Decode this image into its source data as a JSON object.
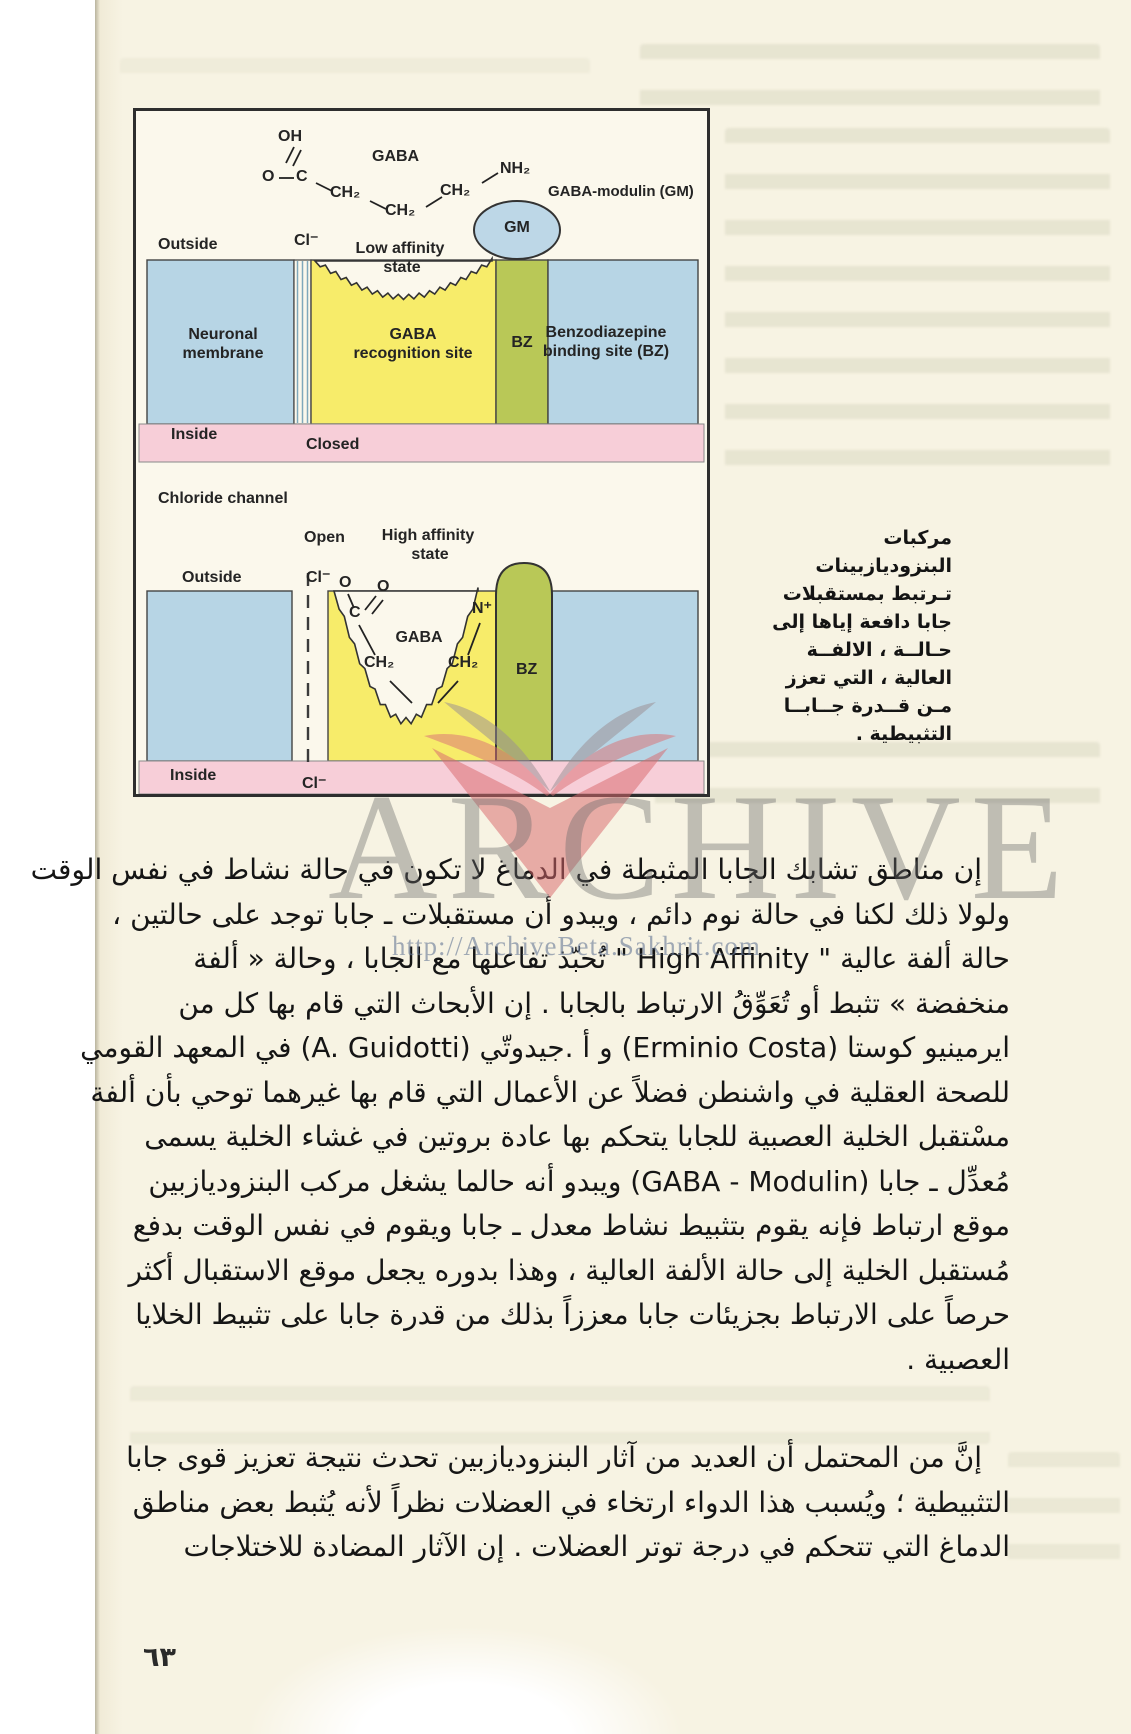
{
  "page": {
    "page_number": "٦٣",
    "watermark": {
      "logo": "open-book-logo",
      "text": "ARCHIVE",
      "url": "http://ArchiveBeta.Sakhrit.com"
    }
  },
  "figure": {
    "panel1": {
      "oh": "OH",
      "o": "O",
      "c": "C",
      "ch2a": "CH₂",
      "ch2b": "CH₂",
      "ch2c": "CH₂",
      "nh2": "NH₂",
      "gaba": "GABA",
      "gaba_modulin": "GABA-modulin (GM)",
      "gm": "GM",
      "outside": "Outside",
      "cl": "Cl⁻",
      "low_affinity": "Low affinity",
      "state": "state",
      "neuronal1": "Neuronal",
      "neuronal2": "membrane",
      "recog1": "GABA",
      "recog2": "recognition site",
      "bz": "BZ",
      "benzo1": "Benzodiazepine",
      "benzo2": "binding site (BZ)",
      "inside": "Inside",
      "closed": "Closed"
    },
    "panel2": {
      "chloride_channel": "Chloride channel",
      "open": "Open",
      "high_affinity": "High affinity",
      "state": "state",
      "outside": "Outside",
      "cl": "Cl⁻",
      "o1": "O",
      "o2": "O",
      "c": "C",
      "gaba": "GABA",
      "nplus": "N⁺",
      "ch2a": "CH₂",
      "ch2b": "CH₂",
      "ch2c": "CH₂",
      "bz": "BZ",
      "inside": "Inside",
      "cl2": "Cl⁻"
    },
    "caption_lines": [
      "مركبات",
      "البنزوديازبينات",
      "تـرتبط بمستقبلات",
      "جابا دافعة إياها إلى",
      "حـالــة ، الالفــة",
      "العالية ، التي تعزز",
      "مـن قــدرة جــابــا",
      "التثبيطية ."
    ]
  },
  "body": {
    "p1": [
      "إن مناطق تشابك الجابا المثبطة في الدماغ لا تكون في حالة نشاط في نفس الوقت",
      "ولولا ذلك لكنا في حالة نوم دائم ، ويبدو أن مستقبلات ـ جابا توجد على حالتين ،",
      "حالة ألفة عالية \" High Affinity \" تُحبّذ تفاعلها مع الجابا ، وحالة « ألفة",
      "منخفضة » تثبط أو تُعَوِّقُ الارتباط بالجابا . إن الأبحاث التي قام بها كل من",
      "ايرمينيو كوستا (Erminio Costa) و أ .جيدوتّي (A. Guidotti) في المعهد القومي",
      "للصحة العقلية في واشنطن فضلاً عن الأعمال التي قام بها غيرهما توحي بأن ألفة",
      "مسْتقبل الخلية العصبية للجابا يتحكم بها عادة بروتين في غشاء الخلية يسمى",
      "مُعدِّل ـ جابا (GABA - Modulin) ويبدو أنه حالما يشغل مركب البنزوديازبين",
      "موقع ارتباط فإنه يقوم بتثبيط نشاط معدل ـ جابا ويقوم في نفس الوقت بدفع",
      "مُستقبل الخلية إلى حالة الألفة العالية ، وهذا بدوره يجعل موقع الاستقبال أكثر",
      "حرصاً على الارتباط بجزيئات جابا معززاً بذلك من قدرة جابا على تثبيط الخلايا",
      "العصبية ."
    ],
    "p2": [
      "إنَّ من المحتمل أن العديد من آثار البنزوديازبين تحدث نتيجة تعزيز قوى جابا",
      "التثبيطية ؛ ويُسبب هذا الدواء ارتخاء في العضلات نظراً لأنه يُثبط بعض مناطق",
      "الدماغ التي تتحكم في درجة توتر العضلات . إن الآثار المضادة للاختلاجات"
    ]
  }
}
